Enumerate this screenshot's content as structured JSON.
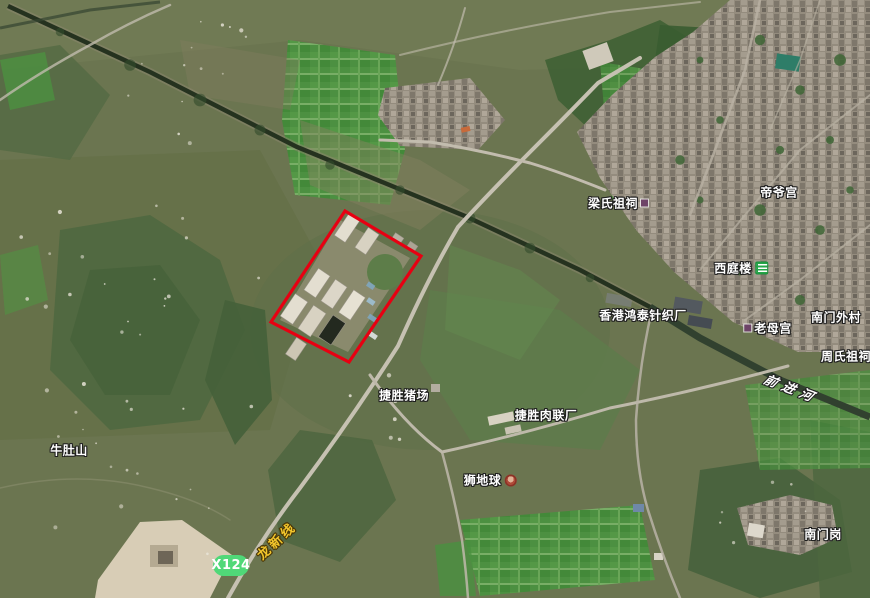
{
  "map_overlay": {
    "road_badge": {
      "text": "X124",
      "bg_color": "#50d878"
    },
    "road_label": {
      "text": "龙新线",
      "color": "#f2c52c"
    },
    "river_label": {
      "text": "前进河",
      "color": "#ffffff"
    },
    "highlight_region": {
      "stroke_color": "#e70012",
      "points": "345,211 421,256 349,362 271,322"
    },
    "poi_labels": [
      {
        "id": "liang-shi-ancestral-hall",
        "text": "梁氏祖祠",
        "x": 618,
        "y": 203,
        "icon": "shrine-icon-purple",
        "icon_side": "right"
      },
      {
        "id": "di-ye-temple",
        "text": "帝爷宫",
        "x": 779,
        "y": 192,
        "icon": "",
        "icon_side": ""
      },
      {
        "id": "xi-ting-building",
        "text": "西庭楼",
        "x": 741,
        "y": 268,
        "icon": "building-icon-green",
        "icon_side": "right"
      },
      {
        "id": "hongkong-hongtai-knitting-factory",
        "text": "香港鸿泰针织厂",
        "x": 643,
        "y": 315,
        "icon": "",
        "icon_side": ""
      },
      {
        "id": "nanmen-outer-village",
        "text": "南门外村",
        "x": 836,
        "y": 317,
        "icon": "",
        "icon_side": ""
      },
      {
        "id": "laomu-temple",
        "text": "老母宫",
        "x": 768,
        "y": 328,
        "icon": "shrine-icon-purple",
        "icon_side": "left"
      },
      {
        "id": "zhou-shi-ancestral-hall",
        "text": "周氏祖祠",
        "x": 846,
        "y": 356,
        "icon": "",
        "icon_side": ""
      },
      {
        "id": "jiesheng-pig-farm",
        "text": "捷胜猪场",
        "x": 404,
        "y": 395,
        "icon": "",
        "icon_side": ""
      },
      {
        "id": "jiesheng-meat-plant",
        "text": "捷胜肉联厂",
        "x": 546,
        "y": 415,
        "icon": "",
        "icon_side": ""
      },
      {
        "id": "shi-di-qiu",
        "text": "狮地球",
        "x": 490,
        "y": 480,
        "icon": "temple-icon-red",
        "icon_side": "right"
      },
      {
        "id": "niudu-mountain",
        "text": "牛肚山",
        "x": 69,
        "y": 450,
        "icon": "",
        "icon_side": ""
      },
      {
        "id": "nanmen-hill",
        "text": "南门岗",
        "x": 823,
        "y": 534,
        "icon": "",
        "icon_side": ""
      }
    ]
  }
}
